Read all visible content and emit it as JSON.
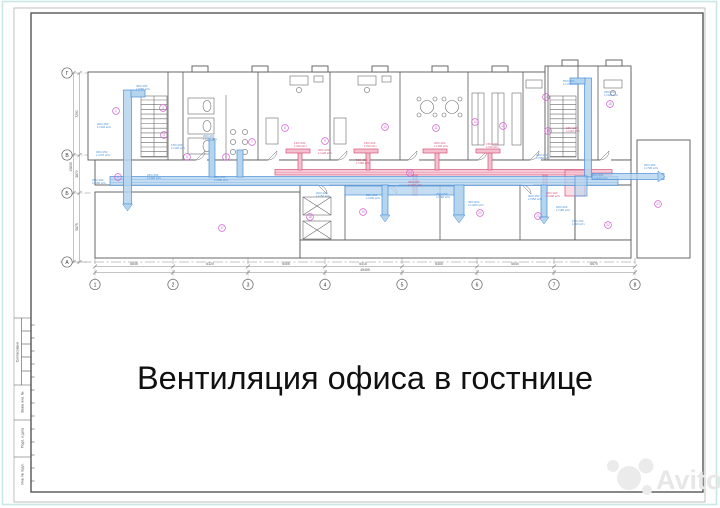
{
  "sheet": {
    "title": "Вентиляция офиса в гостнице",
    "watermark": "Avito"
  },
  "stamp": {
    "labels": [
      "Согласовано",
      "Взам. инв. №",
      "Подп. и дата",
      "Инв. № подл."
    ]
  },
  "grid": {
    "cols": [
      {
        "label": "1",
        "x": 95
      },
      {
        "label": "2",
        "x": 173
      },
      {
        "label": "3",
        "x": 248
      },
      {
        "label": "4",
        "x": 325
      },
      {
        "label": "5",
        "x": 402
      },
      {
        "label": "6",
        "x": 477
      },
      {
        "label": "7",
        "x": 554
      },
      {
        "label": "8",
        "x": 635
      }
    ],
    "col_dims": [
      {
        "text": "6645",
        "x": 134
      },
      {
        "text": "6320",
        "x": 210
      },
      {
        "text": "6405",
        "x": 286
      },
      {
        "text": "6415",
        "x": 363
      },
      {
        "text": "6400",
        "x": 439
      },
      {
        "text": "6540",
        "x": 515
      },
      {
        "text": "6670",
        "x": 594
      }
    ],
    "col_total": {
      "text": "45455",
      "x": 365
    },
    "rows": [
      {
        "label": "Г",
        "y": 73
      },
      {
        "label": "В",
        "y": 155
      },
      {
        "label": "Б",
        "y": 193
      },
      {
        "label": "А",
        "y": 262
      }
    ],
    "row_dims": [
      {
        "text": "7290",
        "y": 114
      },
      {
        "text": "3870",
        "y": 174
      },
      {
        "text": "5875",
        "y": 227
      }
    ],
    "row_total": {
      "text": "15835",
      "y": 167
    }
  },
  "plan": {
    "room_tags": [
      {
        "n": "1",
        "x": 118,
        "y": 177
      },
      {
        "n": "2",
        "x": 116,
        "y": 111
      },
      {
        "n": "3",
        "x": 163,
        "y": 108
      },
      {
        "n": "4",
        "x": 164,
        "y": 135
      },
      {
        "n": "5",
        "x": 187,
        "y": 157
      },
      {
        "n": "6",
        "x": 226,
        "y": 157
      },
      {
        "n": "7",
        "x": 252,
        "y": 142
      },
      {
        "n": "8",
        "x": 285,
        "y": 128
      },
      {
        "n": "9",
        "x": 325,
        "y": 141
      },
      {
        "n": "10",
        "x": 385,
        "y": 127
      },
      {
        "n": "11",
        "x": 436,
        "y": 128
      },
      {
        "n": "12",
        "x": 475,
        "y": 122
      },
      {
        "n": "13",
        "x": 503,
        "y": 126
      },
      {
        "n": "14",
        "x": 546,
        "y": 97
      },
      {
        "n": "15",
        "x": 548,
        "y": 131
      },
      {
        "n": "16",
        "x": 610,
        "y": 104
      },
      {
        "n": "17",
        "x": 222,
        "y": 228
      },
      {
        "n": "18",
        "x": 310,
        "y": 217
      },
      {
        "n": "19",
        "x": 363,
        "y": 212
      },
      {
        "n": "20",
        "x": 480,
        "y": 213
      },
      {
        "n": "21",
        "x": 538,
        "y": 216
      },
      {
        "n": "22",
        "x": 608,
        "y": 225
      },
      {
        "n": "23",
        "x": 658,
        "y": 204
      },
      {
        "n": "24",
        "x": 410,
        "y": 173
      }
    ],
    "duct_labels": [
      {
        "size": "300×150",
        "flow": "L=340 м³/ч",
        "x": 97,
        "y": 125,
        "c": "blue"
      },
      {
        "size": "300×150",
        "flow": "L=270 м³/ч",
        "x": 96,
        "y": 153,
        "c": "blue"
      },
      {
        "size": "250×100",
        "flow": "L=180 м³/ч",
        "x": 92,
        "y": 181,
        "c": "blue"
      },
      {
        "size": "300×150",
        "flow": "L=560 м³/ч",
        "x": 136,
        "y": 87,
        "c": "blue"
      },
      {
        "size": "150×100",
        "flow": "L=120 м³/ч",
        "x": 171,
        "y": 146,
        "c": "blue"
      },
      {
        "size": "200×100",
        "flow": "L=160 м³/ч",
        "x": 203,
        "y": 137,
        "c": "blue"
      },
      {
        "size": "250×150",
        "flow": "L=420 м³/ч",
        "x": 147,
        "y": 176,
        "c": "blue"
      },
      {
        "size": "300×150",
        "flow": "L=680 м³/ч",
        "x": 214,
        "y": 178,
        "c": "blue"
      },
      {
        "size": "200×100",
        "flow": "L=150 м³/ч",
        "x": 316,
        "y": 194,
        "c": "blue"
      },
      {
        "size": "300×200",
        "flow": "L=900 м³/ч",
        "x": 366,
        "y": 196,
        "c": "blue"
      },
      {
        "size": "250×150",
        "flow": "L=300 м³/ч",
        "x": 436,
        "y": 195,
        "c": "blue"
      },
      {
        "size": "400×200",
        "flow": "L=1200 м³/ч",
        "x": 468,
        "y": 203,
        "c": "blue"
      },
      {
        "size": "300×150",
        "flow": "L=450 м³/ч",
        "x": 528,
        "y": 197,
        "c": "blue"
      },
      {
        "size": "500×300",
        "flow": "L=1700 м³/ч",
        "x": 563,
        "y": 82,
        "c": "blue"
      },
      {
        "size": "250×150",
        "flow": "L=340 м³/ч",
        "x": 604,
        "y": 93,
        "c": "blue"
      },
      {
        "size": "300×150",
        "flow": "L=560 м³/ч",
        "x": 536,
        "y": 156,
        "c": "blue"
      },
      {
        "size": "500×300",
        "flow": "L=2100 м³/ч",
        "x": 592,
        "y": 176,
        "c": "blue"
      },
      {
        "size": "300×150",
        "flow": "L=700 м³/ч",
        "x": 644,
        "y": 166,
        "c": "blue"
      },
      {
        "size": "200×100",
        "flow": "L=180 м³/ч",
        "x": 556,
        "y": 208,
        "c": "blue"
      },
      {
        "size": "150×100",
        "flow": "L=90 м³/ч",
        "x": 572,
        "y": 222,
        "c": "blue"
      },
      {
        "size": "150×100",
        "flow": "L=90 м³/ч",
        "x": 294,
        "y": 144,
        "c": "red"
      },
      {
        "size": "200×100",
        "flow": "L=120 м³/ч",
        "x": 318,
        "y": 151,
        "c": "red"
      },
      {
        "size": "150×100",
        "flow": "L=90 м³/ч",
        "x": 364,
        "y": 144,
        "c": "red"
      },
      {
        "size": "200×100",
        "flow": "L=140 м³/ч",
        "x": 434,
        "y": 144,
        "c": "red"
      },
      {
        "size": "150×100",
        "flow": "L=90 м³/ч",
        "x": 486,
        "y": 145,
        "c": "red"
      },
      {
        "size": "300×150",
        "flow": "L=480 м³/ч",
        "x": 356,
        "y": 161,
        "c": "red"
      },
      {
        "size": "250×150",
        "flow": "L=370 м³/ч",
        "x": 408,
        "y": 183,
        "c": "red"
      },
      {
        "size": "200×100",
        "flow": "L=200 м³/ч",
        "x": 546,
        "y": 194,
        "c": "red"
      },
      {
        "size": "150×100",
        "flow": "L=110 м³/ч",
        "x": 566,
        "y": 129,
        "c": "red"
      }
    ]
  },
  "colors": {
    "supply": "#4a90d9",
    "supply_fill": "#b5d5ef",
    "exhaust": "#d5537a",
    "exhaust_fill": "#f4bfce",
    "tag": "#cf5fd0",
    "wall": "#5a5a5a",
    "dim": "#8a8a8a",
    "frame": "#555555",
    "sheet_edge": "#bfe3df",
    "watermark": "#e9e9e9"
  }
}
